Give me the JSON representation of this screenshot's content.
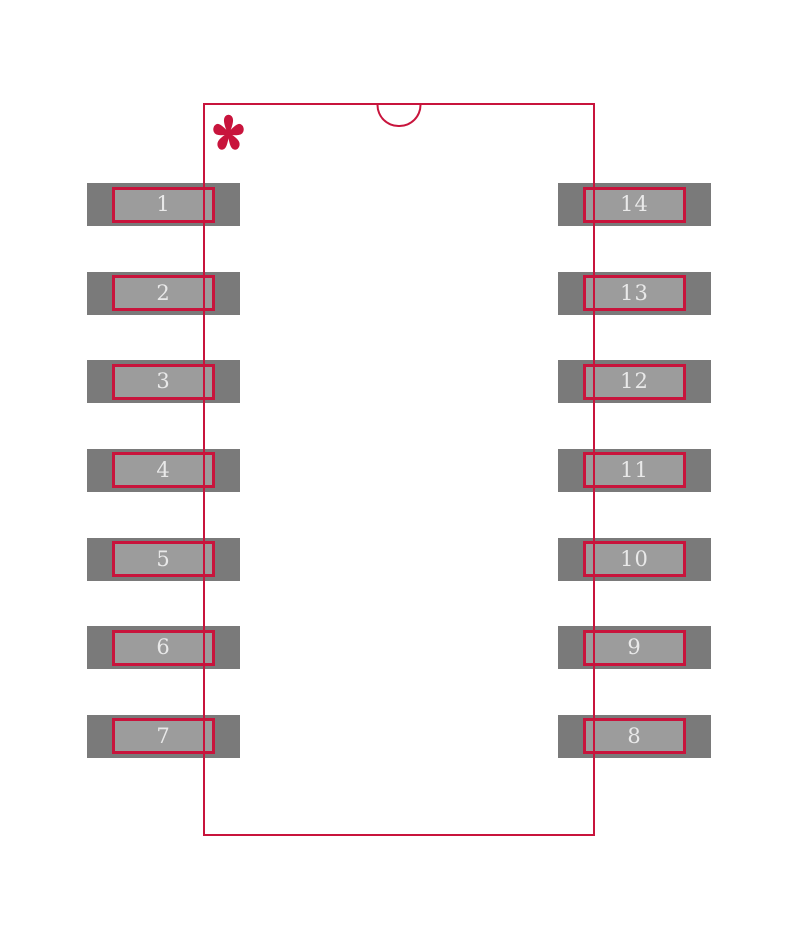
{
  "canvas": {
    "background": "#FFFFFF"
  },
  "footprint": {
    "colors": {
      "outline": "#C8143C",
      "pad_outer": "#7A7A7A",
      "pad_inner": "#9C9C9C",
      "pad_number": "#E9E9E9"
    },
    "pin1_marker_glyph": "*",
    "pads": {
      "left_numbers": [
        "1",
        "2",
        "3",
        "4",
        "5",
        "6",
        "7"
      ],
      "right_numbers": [
        "14",
        "13",
        "12",
        "11",
        "10",
        "9",
        "8"
      ]
    }
  }
}
